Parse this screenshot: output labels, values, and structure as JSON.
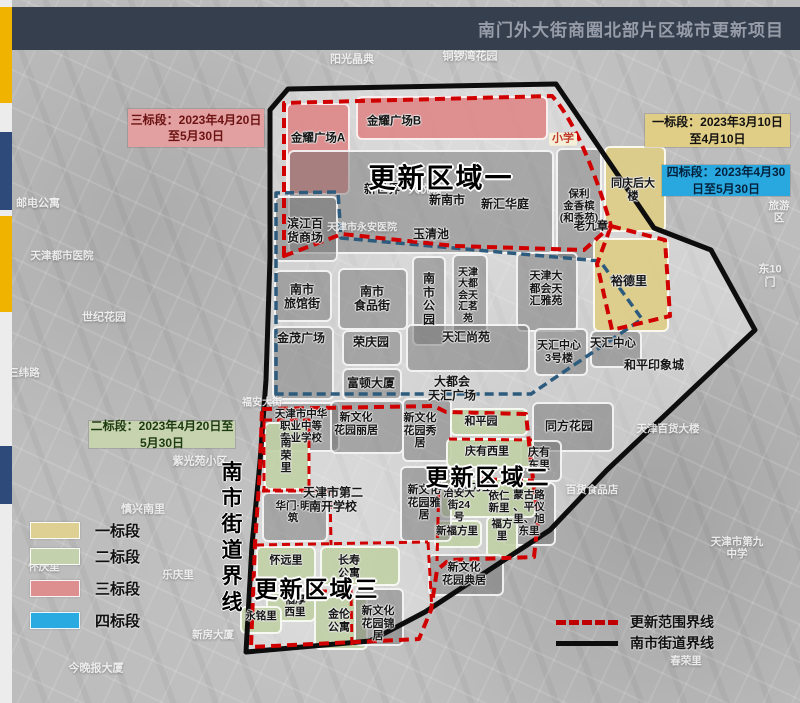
{
  "header": {
    "title": "南门外大街商圈北部片区城市更新项目"
  },
  "colors": {
    "bid1": "#ddd092",
    "bid2": "#c3d2ac",
    "bid3": "#dd8f8f",
    "bid4": "#29abe2",
    "renewal_line": "#d10000",
    "street_line": "#0d0d0d",
    "inner_line": "#2d5b7d",
    "header_bg": "#353f4e",
    "accent_yellow": "#f0b400",
    "accent_blue": "#2e4a7a"
  },
  "date_boxes": [
    {
      "name": "bid3-schedule",
      "lines": [
        "三标段：2023年4月20日",
        "至5月30日"
      ],
      "bg": "#e2a0a0",
      "fg": "#6d1212",
      "x": 128,
      "y": 109,
      "w": 136,
      "h": 38
    },
    {
      "name": "bid1-schedule",
      "lines": [
        "一标段：2023年3月10日",
        "至4月10日"
      ],
      "bg": "#e0cd86",
      "fg": "#111111",
      "x": 645,
      "y": 114,
      "w": 145,
      "h": 33
    },
    {
      "name": "bid4-schedule",
      "lines": [
        "四标段：2023年4月30",
        "日至5月30日"
      ],
      "bg": "#29a8e0",
      "fg": "#04223d",
      "x": 662,
      "y": 165,
      "w": 128,
      "h": 31
    },
    {
      "name": "bid2-schedule",
      "lines": [
        "二标段：2023年4月20日至",
        "5月30日"
      ],
      "bg": "#c6d3ae",
      "fg": "#1d3a0f",
      "x": 89,
      "y": 421,
      "w": 146,
      "h": 27
    }
  ],
  "region_titles": [
    {
      "t": "更新区域一",
      "x": 441,
      "y": 176,
      "s": 27
    },
    {
      "t": "更新区域二",
      "x": 488,
      "y": 475,
      "s": 23
    },
    {
      "t": "更新区域三",
      "x": 317,
      "y": 587,
      "s": 23
    }
  ],
  "street_boundary_vertical": {
    "text": "南市街道界线",
    "x": 232,
    "y": 471,
    "step": 26
  },
  "legend": {
    "items": [
      {
        "name": "bid-1",
        "label": "一标段",
        "color": "#ddd092",
        "y": 520
      },
      {
        "name": "bid-2",
        "label": "二标段",
        "color": "#c3d2ac",
        "y": 546
      },
      {
        "name": "bid-3",
        "label": "三标段",
        "color": "#dd8f8f",
        "y": 578
      },
      {
        "name": "bid-4",
        "label": "四标段",
        "color": "#29abe2",
        "y": 610
      }
    ]
  },
  "line_legend": {
    "items": [
      {
        "name": "renewal-boundary",
        "label": "更新范围界线",
        "style": "red-dash",
        "y": 612
      },
      {
        "name": "street-boundary",
        "label": "南市街道界线",
        "style": "black-solid",
        "y": 633
      }
    ]
  },
  "blocks": [
    {
      "f": "pink",
      "x": 286,
      "y": 103,
      "w": 64,
      "h": 92
    },
    {
      "f": "pink",
      "x": 356,
      "y": 96,
      "w": 192,
      "h": 44
    },
    {
      "f": "gray",
      "x": 288,
      "y": 150,
      "w": 266,
      "h": 104
    },
    {
      "f": "gray",
      "x": 556,
      "y": 148,
      "w": 46,
      "h": 112
    },
    {
      "f": "yellow",
      "x": 604,
      "y": 146,
      "w": 62,
      "h": 86
    },
    {
      "f": "yellow",
      "x": 593,
      "y": 238,
      "w": 76,
      "h": 94
    },
    {
      "f": "gray",
      "x": 274,
      "y": 196,
      "w": 64,
      "h": 66
    },
    {
      "f": "gray",
      "x": 274,
      "y": 270,
      "w": 58,
      "h": 52
    },
    {
      "f": "gray",
      "x": 338,
      "y": 268,
      "w": 70,
      "h": 62
    },
    {
      "f": "gray",
      "x": 412,
      "y": 256,
      "w": 34,
      "h": 90
    },
    {
      "f": "gray",
      "x": 452,
      "y": 254,
      "w": 36,
      "h": 84
    },
    {
      "f": "gray",
      "x": 516,
      "y": 252,
      "w": 62,
      "h": 80
    },
    {
      "f": "gray",
      "x": 272,
      "y": 326,
      "w": 62,
      "h": 74
    },
    {
      "f": "gray",
      "x": 342,
      "y": 330,
      "w": 60,
      "h": 36
    },
    {
      "f": "gray",
      "x": 406,
      "y": 324,
      "w": 124,
      "h": 48
    },
    {
      "f": "gray",
      "x": 534,
      "y": 328,
      "w": 54,
      "h": 48
    },
    {
      "f": "gray",
      "x": 590,
      "y": 330,
      "w": 52,
      "h": 38
    },
    {
      "f": "gray",
      "x": 342,
      "y": 368,
      "w": 60,
      "h": 32
    },
    {
      "f": "gray",
      "x": 532,
      "y": 402,
      "w": 82,
      "h": 50
    },
    {
      "f": "gray",
      "x": 520,
      "y": 440,
      "w": 42,
      "h": 42
    },
    {
      "f": "gray",
      "x": 502,
      "y": 482,
      "w": 54,
      "h": 64
    },
    {
      "f": "gray",
      "x": 262,
      "y": 402,
      "w": 78,
      "h": 50
    },
    {
      "f": "gray",
      "x": 330,
      "y": 400,
      "w": 74,
      "h": 54
    },
    {
      "f": "gray",
      "x": 402,
      "y": 398,
      "w": 50,
      "h": 64
    },
    {
      "f": "green",
      "x": 450,
      "y": 408,
      "w": 78,
      "h": 28
    },
    {
      "f": "green",
      "x": 446,
      "y": 438,
      "w": 88,
      "h": 30
    },
    {
      "f": "green",
      "x": 440,
      "y": 478,
      "w": 96,
      "h": 40
    },
    {
      "f": "green",
      "x": 434,
      "y": 520,
      "w": 48,
      "h": 28
    },
    {
      "f": "green",
      "x": 486,
      "y": 516,
      "w": 32,
      "h": 42
    },
    {
      "f": "gray",
      "x": 400,
      "y": 466,
      "w": 52,
      "h": 76
    },
    {
      "f": "green",
      "x": 264,
      "y": 422,
      "w": 46,
      "h": 68
    },
    {
      "f": "gray",
      "x": 262,
      "y": 492,
      "w": 66,
      "h": 50
    },
    {
      "f": "green",
      "x": 256,
      "y": 546,
      "w": 60,
      "h": 34
    },
    {
      "f": "green",
      "x": 320,
      "y": 546,
      "w": 80,
      "h": 40
    },
    {
      "f": "green",
      "x": 266,
      "y": 592,
      "w": 50,
      "h": 30
    },
    {
      "f": "green",
      "x": 314,
      "y": 596,
      "w": 54,
      "h": 54
    },
    {
      "f": "gray",
      "x": 354,
      "y": 588,
      "w": 50,
      "h": 58
    },
    {
      "f": "gray",
      "x": 428,
      "y": 554,
      "w": 76,
      "h": 42
    },
    {
      "f": "green",
      "x": 240,
      "y": 606,
      "w": 42,
      "h": 28
    }
  ],
  "labels": [
    {
      "t": "金耀广场A",
      "x": 318,
      "y": 139,
      "s": 11.5
    },
    {
      "t": "金耀广场B",
      "x": 394,
      "y": 122,
      "s": 11.5
    },
    {
      "t": "新世界",
      "x": 382,
      "y": 190,
      "s": 12
    },
    {
      "t": "新南市",
      "x": 447,
      "y": 201,
      "s": 12
    },
    {
      "t": "新汇华庭",
      "x": 505,
      "y": 205,
      "s": 12
    },
    {
      "t": "玉清池",
      "x": 431,
      "y": 235,
      "s": 12
    },
    {
      "t": "保利\n金香槟\n(和香苑)",
      "x": 579,
      "y": 207,
      "s": 10.5
    },
    {
      "t": "同庆后大\n楼",
      "x": 633,
      "y": 190,
      "s": 11
    },
    {
      "t": "老九章",
      "x": 591,
      "y": 227,
      "s": 11.5
    },
    {
      "t": "小学",
      "x": 563,
      "y": 139,
      "s": 11,
      "c": "school"
    },
    {
      "t": "滨江百\n货商场",
      "x": 305,
      "y": 231,
      "s": 12
    },
    {
      "t": "南市\n旅馆街",
      "x": 302,
      "y": 297,
      "s": 12
    },
    {
      "t": "南市\n食品街",
      "x": 372,
      "y": 299,
      "s": 12
    },
    {
      "t": "南\n市\n公\n园",
      "x": 429,
      "y": 300,
      "s": 12
    },
    {
      "t": "天津\n大都\n会天\n汇茗\n苑",
      "x": 468,
      "y": 296,
      "s": 10
    },
    {
      "t": "天津大\n都会天\n汇雅苑",
      "x": 546,
      "y": 289,
      "s": 11
    },
    {
      "t": "裕德里",
      "x": 629,
      "y": 282,
      "s": 12
    },
    {
      "t": "金茂广场",
      "x": 301,
      "y": 339,
      "s": 12
    },
    {
      "t": "荣庆园",
      "x": 371,
      "y": 343,
      "s": 12
    },
    {
      "t": "天汇尚苑",
      "x": 466,
      "y": 338,
      "s": 12
    },
    {
      "t": "天汇中心\n3号楼",
      "x": 559,
      "y": 352,
      "s": 11
    },
    {
      "t": "天汇中心",
      "x": 613,
      "y": 344,
      "s": 11.5
    },
    {
      "t": "富顿大厦",
      "x": 371,
      "y": 384,
      "s": 12
    },
    {
      "t": "大都会\n天汇广场",
      "x": 452,
      "y": 389,
      "s": 12
    },
    {
      "t": "和平印象城",
      "x": 654,
      "y": 366,
      "s": 12
    },
    {
      "t": "同方花园",
      "x": 569,
      "y": 427,
      "s": 12
    },
    {
      "t": "庆有\n东里",
      "x": 539,
      "y": 459,
      "s": 11
    },
    {
      "t": "蒙古路\n、平仪\n里、旭\n东里",
      "x": 529,
      "y": 514,
      "s": 10.5
    },
    {
      "t": "天津市中华\n职业中等\n专业学校",
      "x": 301,
      "y": 427,
      "s": 10.5
    },
    {
      "t": "新文化\n花园丽居",
      "x": 356,
      "y": 424,
      "s": 11
    },
    {
      "t": "新文化\n花园秀\n居",
      "x": 420,
      "y": 431,
      "s": 11
    },
    {
      "t": "和平园",
      "x": 481,
      "y": 422,
      "s": 11
    },
    {
      "t": "庆有西里",
      "x": 487,
      "y": 452,
      "s": 11
    },
    {
      "t": "移方里",
      "x": 477,
      "y": 488,
      "s": 10.5
    },
    {
      "t": "治安大\n街24\n号",
      "x": 459,
      "y": 506,
      "s": 10.5
    },
    {
      "t": "依仁\n新里",
      "x": 499,
      "y": 503,
      "s": 10.5
    },
    {
      "t": "福方\n里",
      "x": 502,
      "y": 531,
      "s": 10.5
    },
    {
      "t": "新福方里",
      "x": 457,
      "y": 532,
      "s": 10.5
    },
    {
      "t": "楼",
      "x": 437,
      "y": 487,
      "s": 10
    },
    {
      "t": "南\n荣\n里",
      "x": 286,
      "y": 456,
      "s": 11
    },
    {
      "t": "华门·明\n筑",
      "x": 293,
      "y": 513,
      "s": 10.5
    },
    {
      "t": "天津市第二\n南开学校",
      "x": 333,
      "y": 500,
      "s": 12
    },
    {
      "t": "新文化\n花园雅\n居",
      "x": 424,
      "y": 503,
      "s": 11
    },
    {
      "t": "怀远里",
      "x": 286,
      "y": 561,
      "s": 11
    },
    {
      "t": "长寿\n公寓",
      "x": 349,
      "y": 567,
      "s": 11
    },
    {
      "t": "福厚\n西里",
      "x": 295,
      "y": 607,
      "s": 10.5
    },
    {
      "t": "永铭里",
      "x": 261,
      "y": 617,
      "s": 10.5
    },
    {
      "t": "金伦\n公寓",
      "x": 339,
      "y": 621,
      "s": 11
    },
    {
      "t": "新文化\n花园锦\n居",
      "x": 378,
      "y": 624,
      "s": 11
    },
    {
      "t": "新文化\n花园典居",
      "x": 464,
      "y": 574,
      "s": 11
    },
    {
      "t": "阳光晶典",
      "x": 352,
      "y": 60,
      "s": 11,
      "c": "faint"
    },
    {
      "t": "铜锣湾花园",
      "x": 470,
      "y": 57,
      "s": 11,
      "c": "faint"
    },
    {
      "t": "邮电公寓",
      "x": 38,
      "y": 204,
      "s": 11,
      "c": "faint"
    },
    {
      "t": "大悦城",
      "x": 425,
      "y": 190,
      "s": 11,
      "c": "faint"
    },
    {
      "t": "天津都市医院",
      "x": 62,
      "y": 257,
      "s": 10.5,
      "c": "faint"
    },
    {
      "t": "世纪花园",
      "x": 104,
      "y": 318,
      "s": 11,
      "c": "faint"
    },
    {
      "t": "三纬路",
      "x": 24,
      "y": 374,
      "s": 10.5,
      "c": "faint"
    },
    {
      "t": "天津市永安医院",
      "x": 362,
      "y": 228,
      "s": 10,
      "c": "faint"
    },
    {
      "t": "福安大街",
      "x": 262,
      "y": 403,
      "s": 10,
      "c": "faint"
    },
    {
      "t": "紫光苑小区",
      "x": 200,
      "y": 462,
      "s": 11,
      "c": "faint"
    },
    {
      "t": "慎兴南里",
      "x": 143,
      "y": 510,
      "s": 11,
      "c": "faint"
    },
    {
      "t": "怀庆里",
      "x": 44,
      "y": 568,
      "s": 10.5,
      "c": "faint"
    },
    {
      "t": "乐庆里",
      "x": 178,
      "y": 576,
      "s": 10.5,
      "c": "faint"
    },
    {
      "t": "今晚报大厦",
      "x": 96,
      "y": 669,
      "s": 11,
      "c": "faint"
    },
    {
      "t": "新房大厦",
      "x": 213,
      "y": 636,
      "s": 10.5,
      "c": "faint"
    },
    {
      "t": "东10门",
      "x": 770,
      "y": 276,
      "s": 11,
      "c": "faint"
    },
    {
      "t": "旅游区",
      "x": 779,
      "y": 213,
      "s": 10.5,
      "c": "faint"
    },
    {
      "t": "天津百货大楼",
      "x": 668,
      "y": 430,
      "s": 10.5,
      "c": "faint"
    },
    {
      "t": "百货食品店",
      "x": 592,
      "y": 491,
      "s": 10.5,
      "c": "faint"
    },
    {
      "t": "天津市第九\n中学",
      "x": 737,
      "y": 549,
      "s": 10.5,
      "c": "faint"
    },
    {
      "t": "春荣里",
      "x": 686,
      "y": 662,
      "s": 10.5,
      "c": "faint"
    }
  ]
}
